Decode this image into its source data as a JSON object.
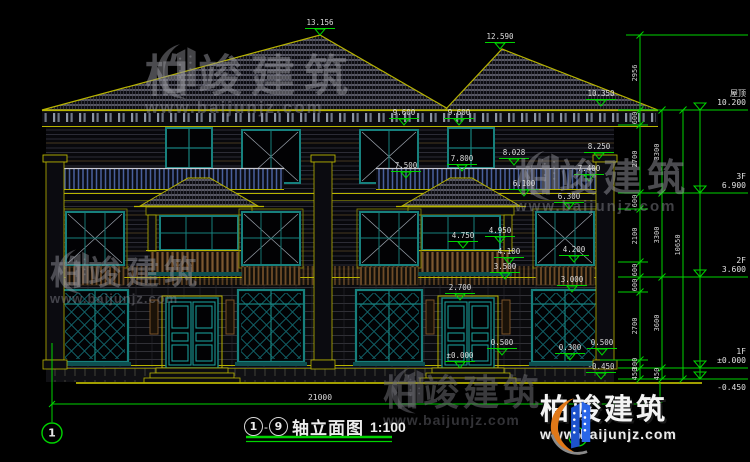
{
  "drawing": {
    "title": {
      "axis_left": "1",
      "dash": "-",
      "axis_right": "9",
      "name": "轴立面图",
      "scale": "1:100"
    },
    "total_width_dim": "21000",
    "axis_bubble_left": "1",
    "axis_bubble_right": "9",
    "colors": {
      "line_yellow": "#b8b400",
      "dim_green": "#00d400",
      "window_teal": "#17807d",
      "text": "#dcdcdc"
    },
    "annotations": [
      {
        "t": "13.156",
        "x": 320,
        "apex": 35
      },
      {
        "t": "12.590",
        "x": 500,
        "apex": 49
      },
      {
        "t": "10.350",
        "x": 601,
        "apex": 106
      },
      {
        "t": "9.600",
        "x": 404,
        "apex": 125
      },
      {
        "t": "9.600",
        "x": 459,
        "apex": 125
      },
      {
        "t": "8.250",
        "x": 599,
        "apex": 159
      },
      {
        "t": "8.028",
        "x": 514,
        "apex": 165
      },
      {
        "t": "7.800",
        "x": 462,
        "apex": 171
      },
      {
        "t": "7.500",
        "x": 406,
        "apex": 178
      },
      {
        "t": "7.400",
        "x": 589,
        "apex": 181
      },
      {
        "t": "6.100",
        "x": 524,
        "apex": 196
      },
      {
        "t": "6.300",
        "x": 569,
        "apex": 209
      },
      {
        "t": "4.950",
        "x": 500,
        "apex": 243
      },
      {
        "t": "4.750",
        "x": 463,
        "apex": 248
      },
      {
        "t": "4.200",
        "x": 574,
        "apex": 262
      },
      {
        "t": "4.100",
        "x": 509,
        "apex": 264
      },
      {
        "t": "3.500",
        "x": 505,
        "apex": 279
      },
      {
        "t": "3.000",
        "x": 572,
        "apex": 292
      },
      {
        "t": "2.700",
        "x": 460,
        "apex": 300
      },
      {
        "t": "0.500",
        "x": 502,
        "apex": 355
      },
      {
        "t": "0.500",
        "x": 602,
        "apex": 355
      },
      {
        "t": "0.300",
        "x": 570,
        "apex": 360
      },
      {
        "t": "±0.000",
        "x": 460,
        "apex": 368
      },
      {
        "t": "-0.450",
        "x": 601,
        "apex": 379
      }
    ],
    "dim_chains": [
      {
        "x": 640,
        "ticks": [
          35,
          110,
          125,
          193,
          209,
          262,
          277,
          292,
          360,
          368,
          379
        ],
        "labels": [
          "2956",
          "600",
          "2700",
          "600",
          "2100",
          "600",
          "600",
          "2700",
          "300",
          "450"
        ]
      },
      {
        "x": 662,
        "ticks": [
          110,
          193,
          277,
          368,
          379
        ],
        "labels": [
          "3300",
          "3300",
          "3600",
          "450"
        ]
      },
      {
        "x": 683,
        "ticks": [
          110,
          379
        ],
        "labels": [
          "10650"
        ]
      }
    ],
    "levels_right": [
      {
        "label": "屋顶",
        "value": "10.200",
        "y": 110
      },
      {
        "label": "3F",
        "value": "6.900",
        "y": 193
      },
      {
        "label": "2F",
        "value": "3.600",
        "y": 277
      },
      {
        "label": "1F",
        "value": "±0.000",
        "y": 368
      },
      {
        "label": "",
        "value": "-0.450",
        "y": 379
      }
    ]
  },
  "watermark": {
    "brand": "柏竣建筑",
    "url": "www.baijunjz.com"
  },
  "logo": {
    "brand": "柏竣建筑",
    "url": "www.baijunjz.com"
  }
}
